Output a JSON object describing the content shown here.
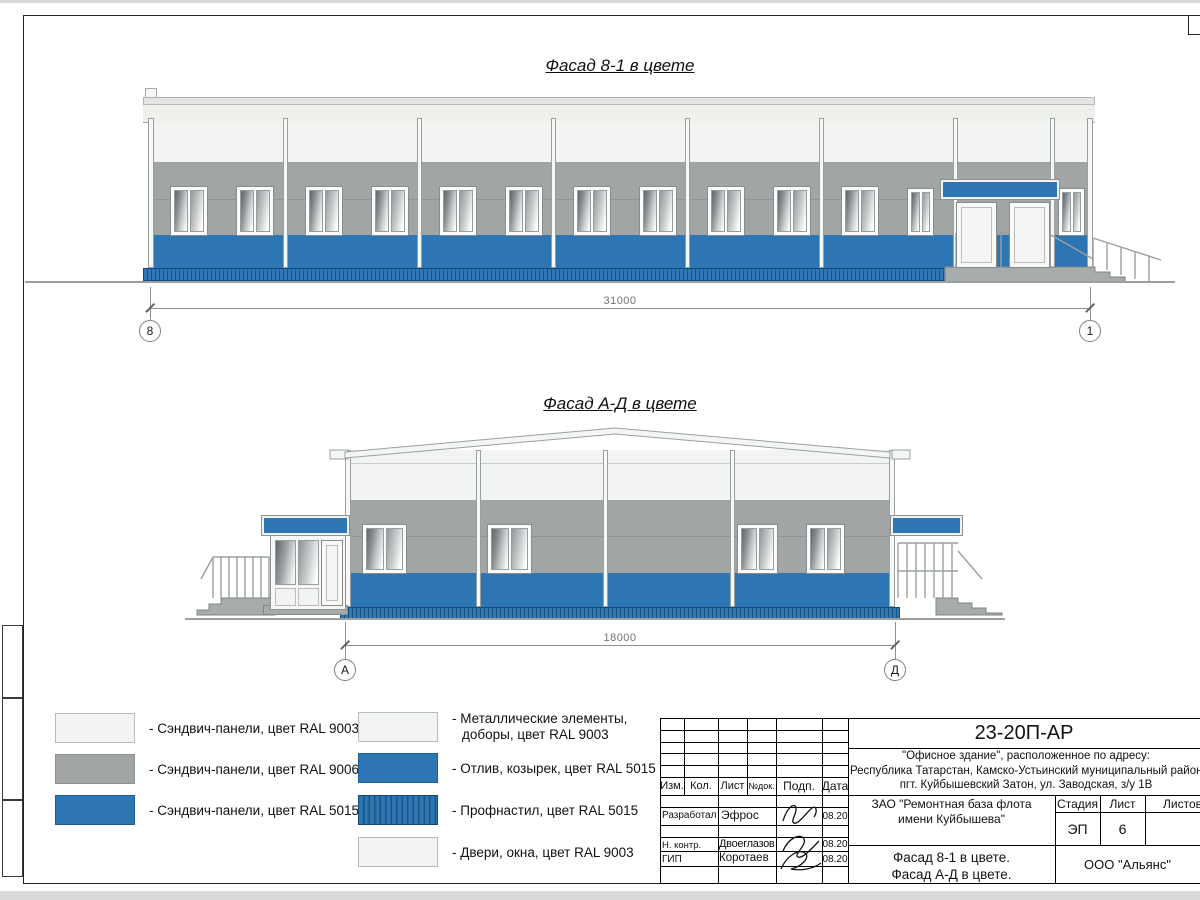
{
  "titles": {
    "facade_8_1": "Фасад 8-1 в цвете",
    "facade_a_d": "Фасад А-Д в цвете"
  },
  "dimensions": {
    "facade_8_1": {
      "length": "31000",
      "axis_left": "8",
      "axis_right": "1"
    },
    "facade_a_d": {
      "length": "18000",
      "axis_left": "А",
      "axis_right": "Д"
    }
  },
  "legend": {
    "left_column": [
      {
        "label": "- Сэндвич-панели, цвет RAL 9003"
      },
      {
        "label": "- Сэндвич-панели, цвет RAL 9006"
      },
      {
        "label": "- Сэндвич-панели, цвет RAL 5015"
      }
    ],
    "right_column": [
      {
        "label": "- Металлические элементы,",
        "label2": "доборы, цвет RAL 9003"
      },
      {
        "label": "- Отлив, козырек, цвет RAL 5015"
      },
      {
        "label": "- Профнастил, цвет RAL 5015"
      },
      {
        "label": "- Двери, окна, цвет RAL 9003"
      }
    ]
  },
  "title_block": {
    "doc_number": "23-20П-АР",
    "address_line1": "\"Офисное здание\", расположенное по адресу:",
    "address_line2": "Республика Татарстан, Камско-Устьинский муниципальный район,",
    "address_line3": "пгт. Куйбышевский Затон, ул. Заводская, з/у 1В",
    "headers": {
      "izm": "Изм.",
      "kol": "Кол.",
      "list": "Лист",
      "ndok": "№док.",
      "podp": "Подп.",
      "data": "Дата"
    },
    "staff": [
      {
        "role": "Разработал",
        "name": "Эфрос",
        "date": "08.20"
      },
      {
        "role": "Н. контр.",
        "name": "Двоеглазов",
        "date": "08.20"
      },
      {
        "role": "ГИП",
        "name": "Коротаев",
        "date": "08.20"
      }
    ],
    "client_line1": "ЗАО \"Ремонтная база флота",
    "client_line2": "имени Куйбышева\"",
    "stage_label": "Стадия",
    "list_label": "Лист",
    "listov_label": "Листов",
    "stage_value": "ЭП",
    "list_value": "6",
    "sheet_name_line1": "Фасад 8-1 в цвете.",
    "sheet_name_line2": "Фасад А-Д в цвете.",
    "company": "ООО \"Альянс\""
  },
  "colors": {
    "ral9003": "#f2f4f1",
    "ral9006": "#a1a5a5",
    "ral5015": "#2d75b3"
  }
}
